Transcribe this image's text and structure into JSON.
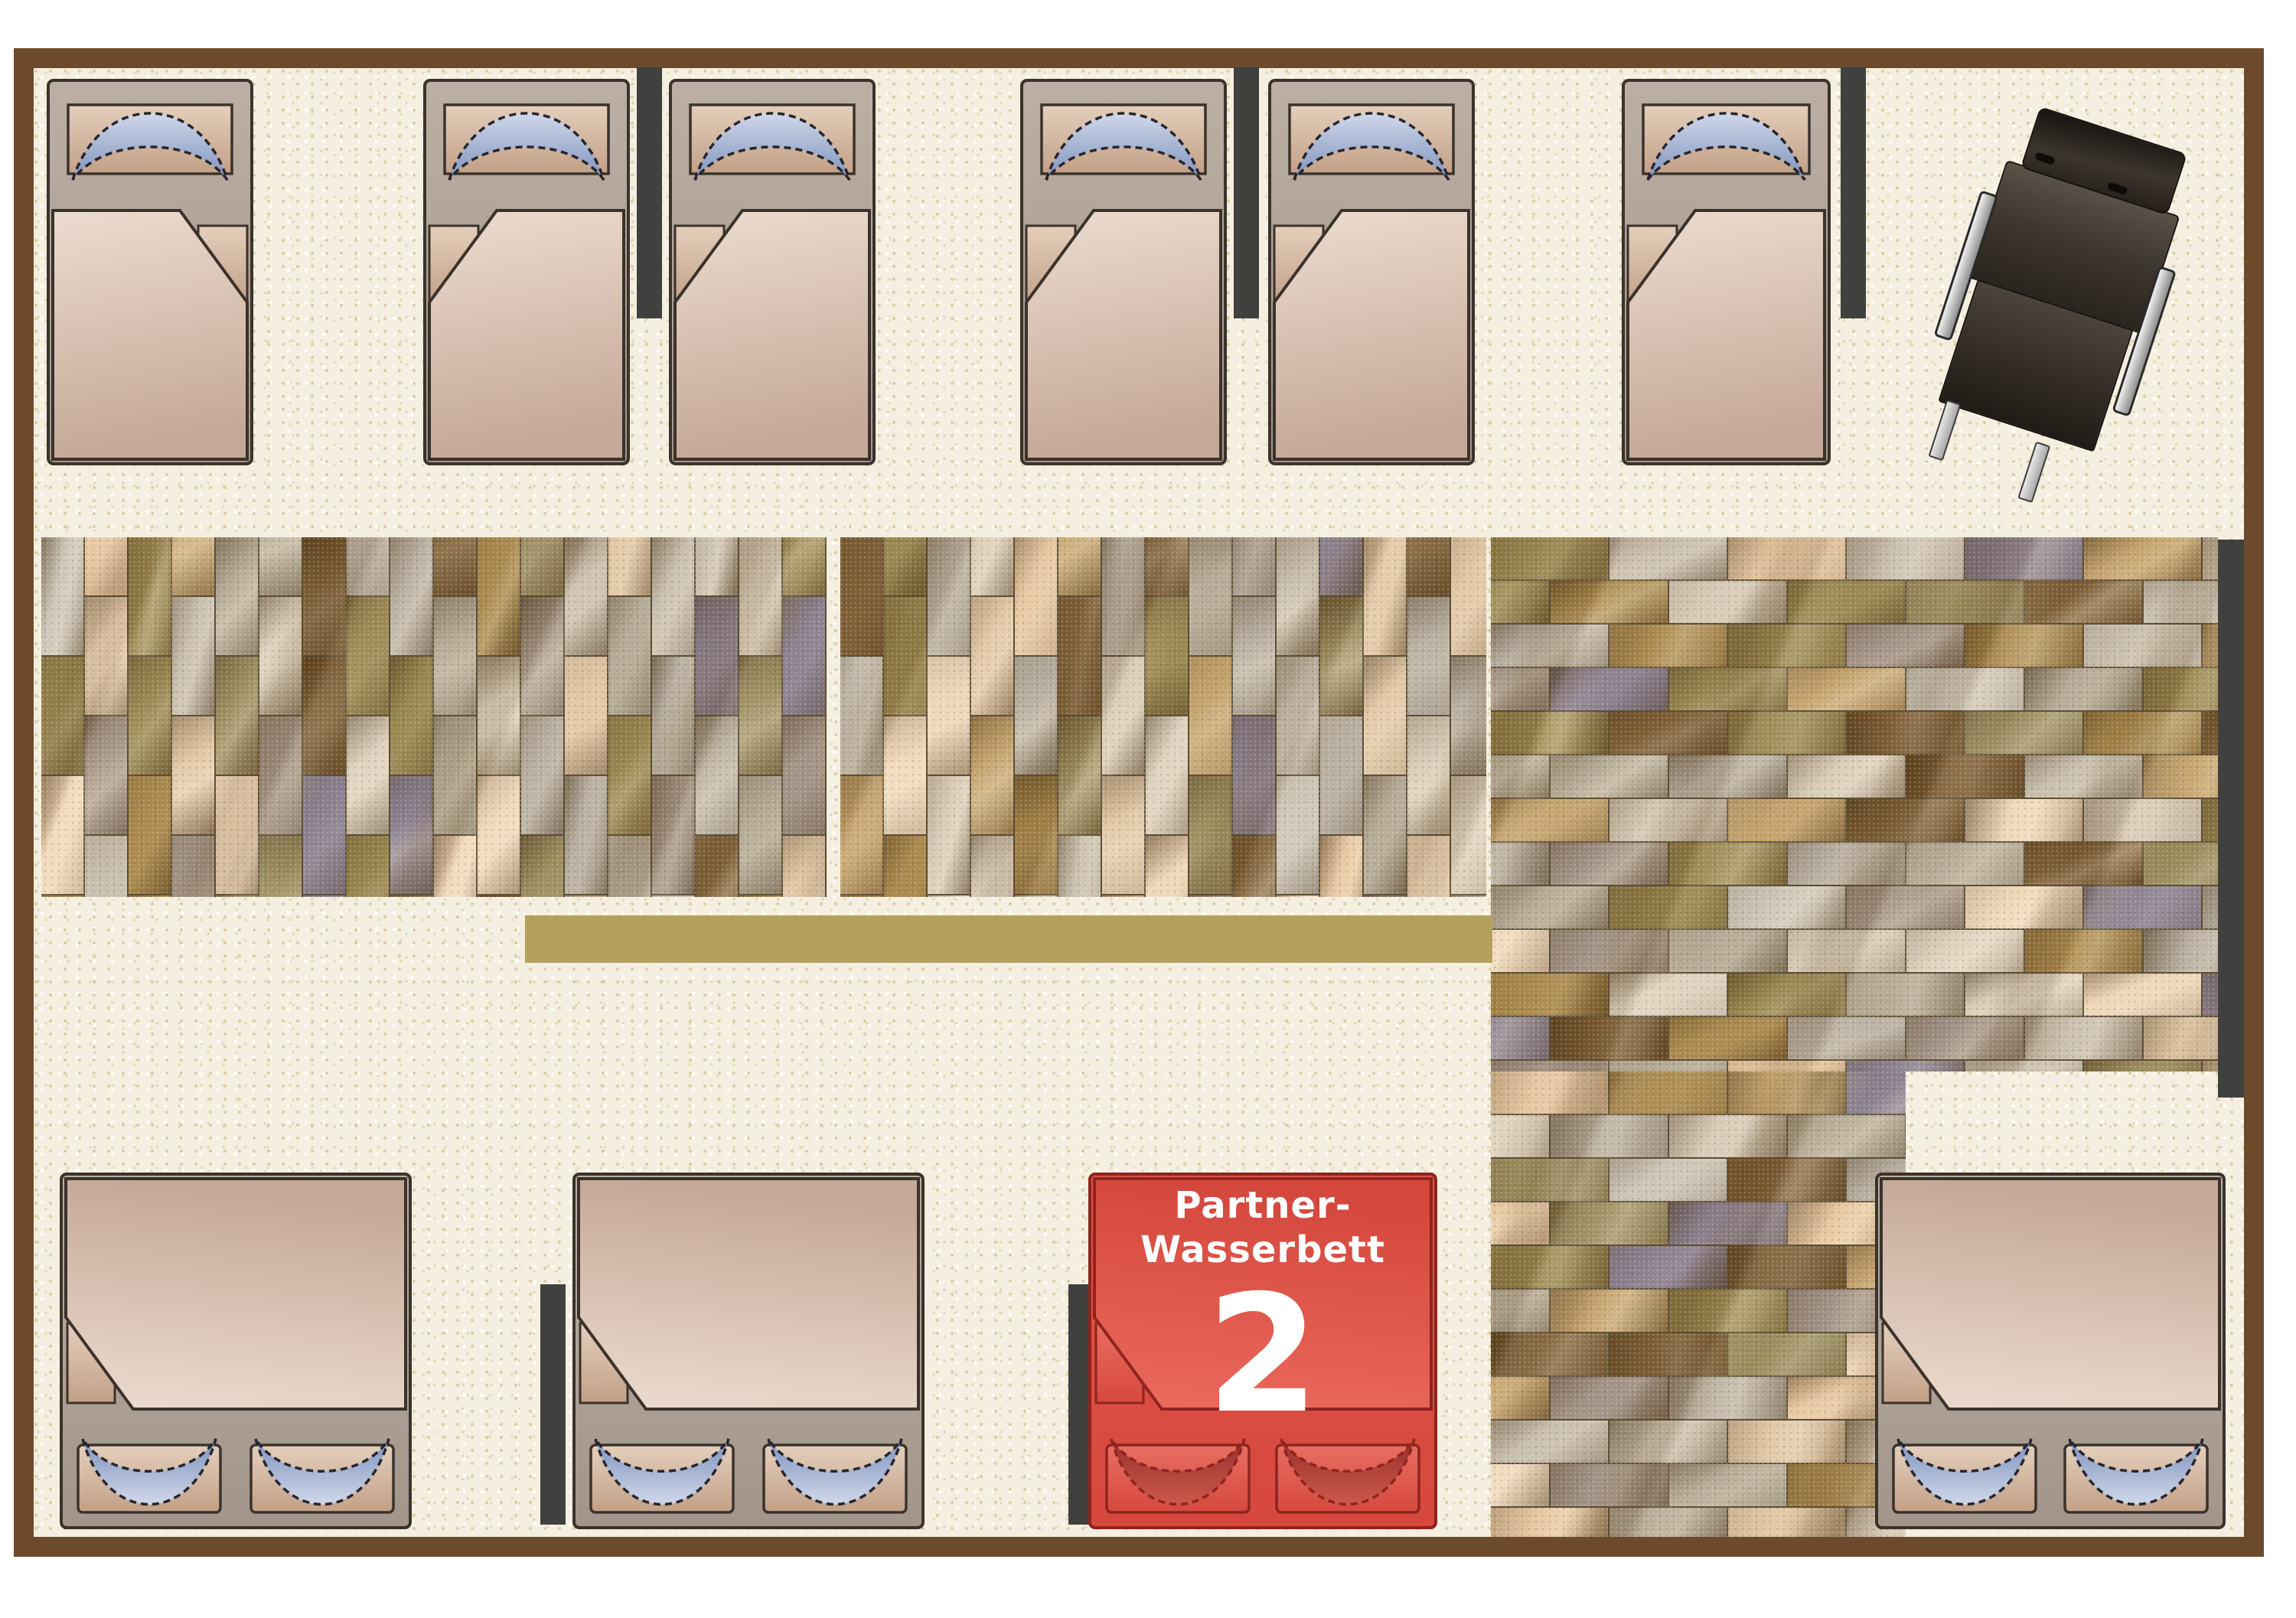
{
  "plan": {
    "type": "showroom-floor-plan",
    "beds": {
      "single_count": 6,
      "double_count": 3,
      "highlighted": {
        "label_line1": "Partner-",
        "label_line2": "Wasserbett",
        "number": "2"
      }
    }
  },
  "colors": {
    "wall": "#6d4a2c",
    "wall_segment": "#40403e",
    "floor": "#f4efe0",
    "bench_gold": "#b4a15e",
    "bed_border": "#3b332b",
    "bed_frame_light": "#bcafa3",
    "bed_frame_dark": "#a2958a",
    "sheet_light": "#e4cfbc",
    "sheet_dark": "#c2a087",
    "blanket_light": "#ecdccf",
    "blanket_dark": "#c5a897",
    "pillow_light": "#d0d8ea",
    "pillow_dark": "#7e92bd",
    "pillow_outline": "#26262e",
    "red_body": "#e0544a",
    "red_body_dark": "#d6483e",
    "red_outline": "#8e241d",
    "red_blanket_light": "#ec6a5e",
    "red_blanket_dark": "#d4473c",
    "red_sheet": "#e86e62",
    "red_pillow_light": "#cd574d",
    "red_pillow_dark": "#97302a",
    "stone_mortar": "#5f5138",
    "stone_palette": [
      "#cdc6b8",
      "#b9b0a2",
      "#d8cbb8",
      "#e8c8a2",
      "#f0d8ba",
      "#ab8a4e",
      "#97854e",
      "#8d8292",
      "#a39386",
      "#7d5e36",
      "#c5a36d",
      "#b5ab97",
      "#dfd3c0",
      "#9c8e60",
      "#c9bfae",
      "#e2c9a8"
    ],
    "chair_body": "#3f3831",
    "chair_metal": "#d9d9d9"
  }
}
